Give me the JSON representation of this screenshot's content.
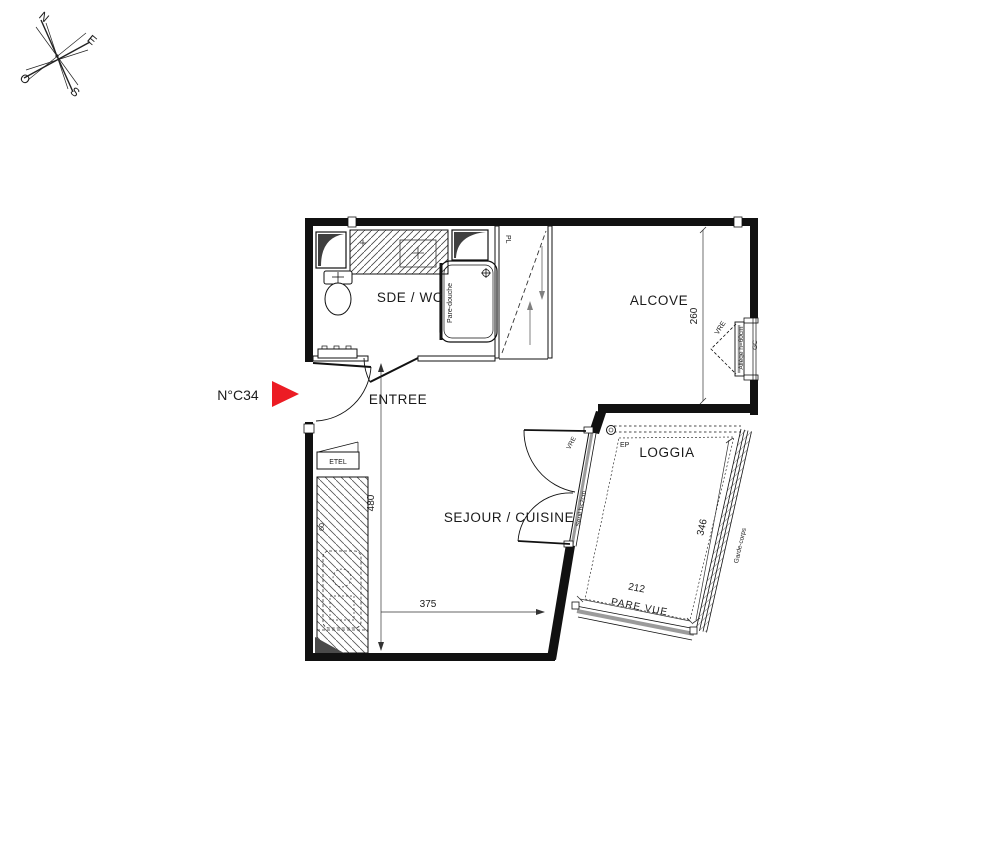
{
  "unit": {
    "label": "N°C34"
  },
  "compass": {
    "n": "N",
    "e": "E",
    "s": "S",
    "o": "O"
  },
  "rooms": {
    "sde_wc": "SDE / WC",
    "entree": "ENTREE",
    "alcove": "ALCOVE",
    "sejour_cuisine": "SEJOUR / CUISINE",
    "loggia": "LOGGIA"
  },
  "dims": {
    "alcove_depth": "260",
    "entry_height": "480",
    "sejour_width": "375",
    "loggia_length": "346",
    "loggia_width": "212",
    "worktop_depth": "60"
  },
  "ann": {
    "pare_douche": "Pare-douche",
    "pl": "PL",
    "etel": "ETEL",
    "ep": "EP",
    "vre": "VRE",
    "allege": "Allège h=60cm",
    "gc": "GC",
    "garde_corps": "Garde-corps",
    "pare_vue": "PARE VUE",
    "seuil": "Seuil h<2cm"
  },
  "colors": {
    "accent_red": "#EC1C24",
    "ink": "#1a1a1a",
    "gray_arrow": "#808080",
    "glazing_gray": "#9B9B9B"
  }
}
